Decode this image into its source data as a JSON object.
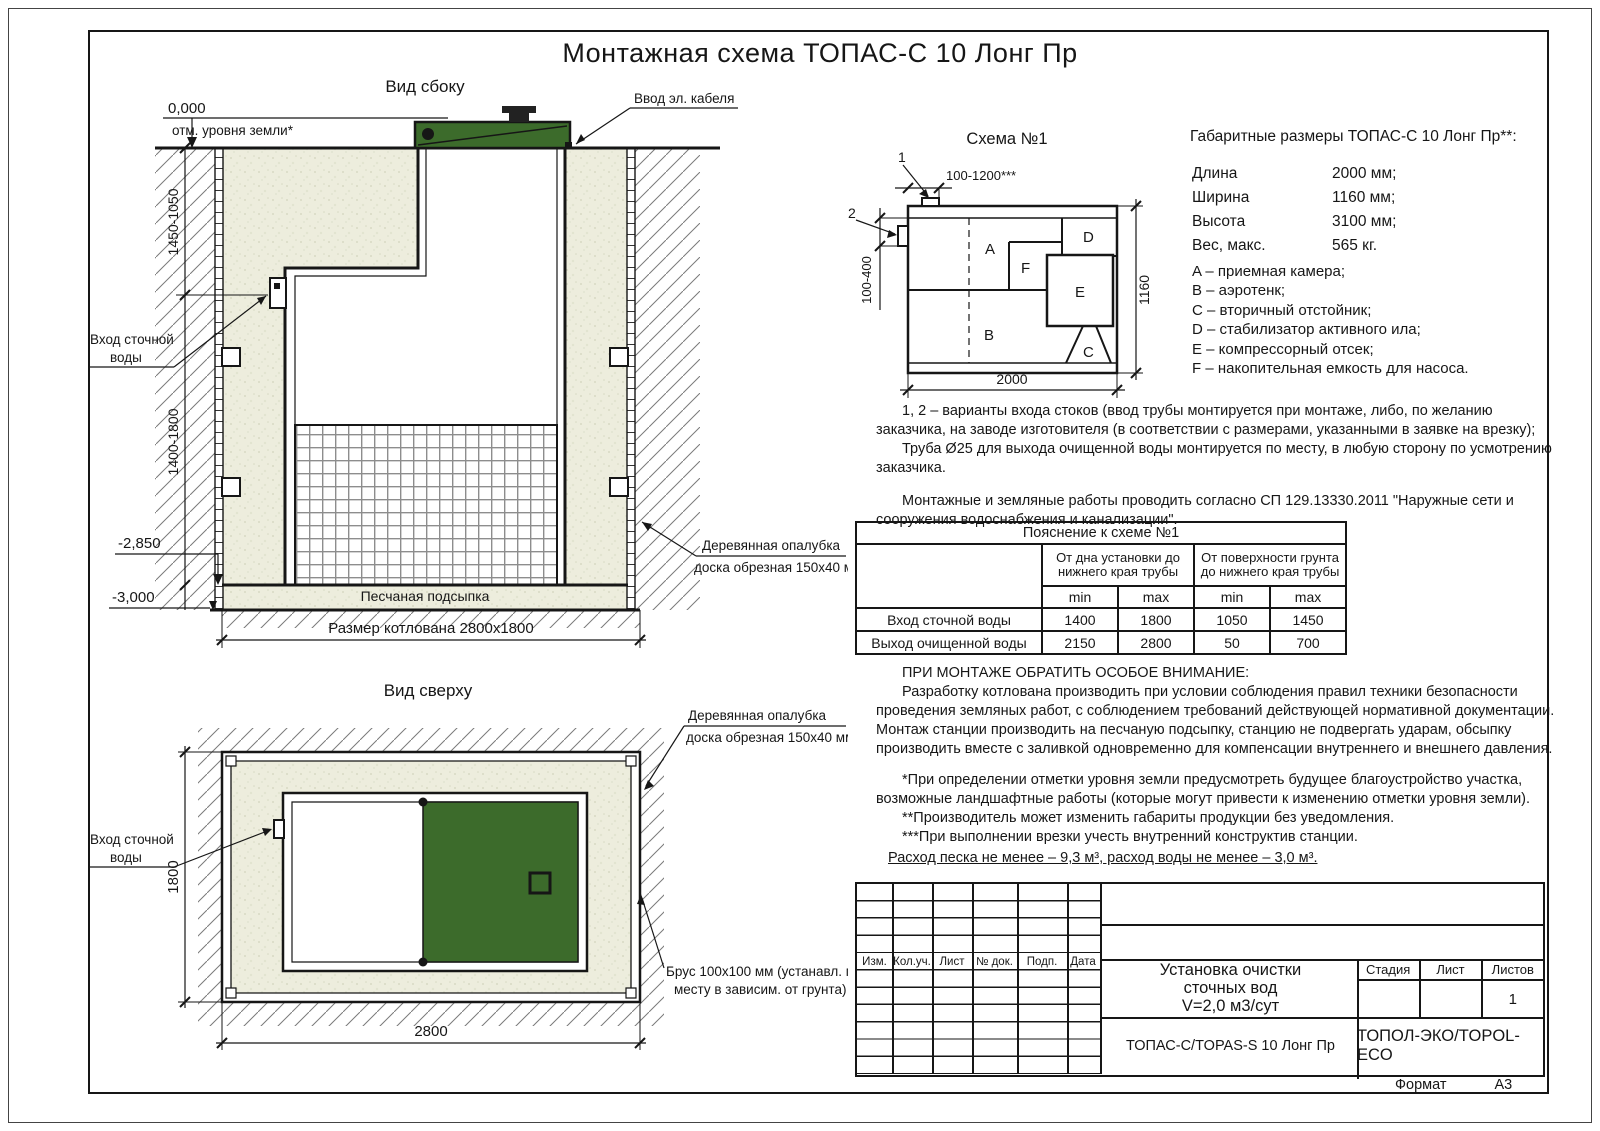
{
  "page": {
    "title": "Монтажная схема ТОПАС-С 10 Лонг Пр",
    "format_label": "Формат",
    "format_value": "А3"
  },
  "side_view": {
    "title": "Вид сбоку",
    "level_zero": "0,000",
    "level_zero_note": "отм. уровня земли*",
    "cable_entry": "Ввод эл. кабеля",
    "inlet_line1": "Вход сточной",
    "inlet_line2": "воды",
    "dim_upper": "1450-1050",
    "dim_lower": "1400-1800",
    "level_sand": "-2,850",
    "level_bottom": "-3,000",
    "sand_bed": "Песчаная подсыпка",
    "pit_size": "Размер котлована 2800x1800",
    "formwork_line1": "Деревянная опалубка",
    "formwork_line2": "доска обрезная 150x40 мм"
  },
  "top_view": {
    "title": "Вид сверху",
    "formwork_line1": "Деревянная опалубка",
    "formwork_line2": "доска обрезная 150x40 мм",
    "inlet_line1": "Вход сточной",
    "inlet_line2": "воды",
    "dim_height": "1800",
    "dim_width": "2800",
    "beam_line1": "Брус 100x100 мм (устанавл. по",
    "beam_line2": "месту в зависим. от грунта)"
  },
  "schema": {
    "title": "Схема №1",
    "callout1": "1",
    "callout2": "2",
    "dim_inlet_top": "100-1200***",
    "dim_inlet_side": "100-400",
    "dim_length": "2000",
    "dim_width": "1160",
    "comp_a": "A",
    "comp_b": "B",
    "comp_c": "C",
    "comp_d": "D",
    "comp_e": "E",
    "comp_f": "F"
  },
  "specs": {
    "title": "Габаритные размеры ТОПАС-С 10 Лонг Пр**:",
    "rows": [
      {
        "label": "Длина",
        "value": "2000 мм;"
      },
      {
        "label": "Ширина",
        "value": "1160 мм;"
      },
      {
        "label": "Высота",
        "value": "3100 мм;"
      },
      {
        "label": "Вес, макс.",
        "value": "565 кг."
      }
    ],
    "legend": [
      "A – приемная камера;",
      "B – аэротенк;",
      "C – вторичный отстойник;",
      "D – стабилизатор активного ила;",
      "E – компрессорный отсек;",
      "F – накопительная емкость для насоса."
    ]
  },
  "notes": {
    "variants": "1, 2 – варианты входа стоков (ввод трубы монтируется при монтаже, либо, по желанию заказчика, на заводе изготовителя (в соответствии с размерами, указанными в заявке на врезку);",
    "pipe": "Труба Ø25 для выхода очищенной воды монтируется по месту, в любую сторону по усмотрению заказчика.",
    "works": "Монтажные и земляные работы проводить согласно СП 129.13330.2011 \"Наружные сети и сооружения водоснабжения и канализации\"."
  },
  "table": {
    "title": "Пояснение к схеме №1",
    "group1": "От дна установки до нижнего края трубы",
    "group2": "От поверхности грунта до нижнего края трубы",
    "min_label": "min",
    "max_label": "max",
    "rows": [
      {
        "name": "Вход сточной воды",
        "v1": "1400",
        "v2": "1800",
        "v3": "1050",
        "v4": "1450"
      },
      {
        "name": "Выход очищенной воды",
        "v1": "2150",
        "v2": "2800",
        "v3": "50",
        "v4": "700"
      }
    ]
  },
  "attention": {
    "heading": "ПРИ МОНТАЖЕ ОБРАТИТЬ ОСОБОЕ ВНИМАНИЕ:",
    "body": "Разработку котлована производить при условии соблюдения правил техники безопасности проведения земляных работ, с соблюдением требований действующей нормативной документации. Монтаж станции производить на песчаную подсыпку, станцию не подвергать ударам, обсыпку производить вместе с заливкой одновременно для компенсации внутреннего и внешнего давления.",
    "star1": "*При определении отметки уровня земли предусмотреть будущее благоустройство участка, возможные ландшафтные работы (которые могут привести к изменению отметки уровня земли).",
    "star2": "**Производитель может изменить габариты продукции без уведомления.",
    "star3": "***При выполнении врезки учесть внутренний конструктив станции.",
    "consumption": "Расход песка не менее – 9,3 м³, расход воды не менее – 3,0 м³."
  },
  "title_block": {
    "rev_headers": [
      "Изм.",
      "Кол.уч.",
      "Лист",
      "№ док.",
      "Подп.",
      "Дата"
    ],
    "product_line1": "Установка очистки",
    "product_line2": "сточных вод",
    "product_line3": "V=2,0 м3/сут",
    "stage_label": "Стадия",
    "sheet_label": "Лист",
    "sheets_label": "Листов",
    "sheets_value": "1",
    "model": "ТОПАС-С/TOPAS-S 10 Лонг Пр",
    "company": "ТОПОЛ-ЭКО/TOPOL-ECO"
  },
  "colors": {
    "lid_green": "#3c6b2b",
    "sand": "#ededdd",
    "line": "#161616"
  }
}
